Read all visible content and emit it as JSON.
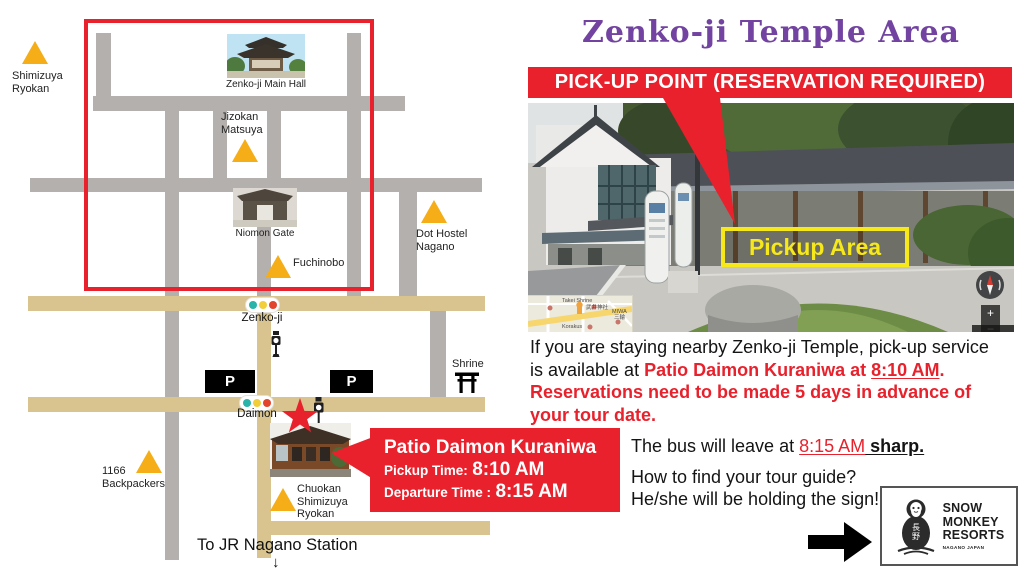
{
  "title": "Zenko-ji Temple Area",
  "banner": "PICK-UP POINT (RESERVATION REQUIRED)",
  "colors": {
    "red": "#e8212c",
    "purple_title": "#7243a0",
    "marker_yellow": "#f5ad18",
    "road_gray": "#b3b0ae",
    "road_tan": "#d9c48f",
    "pickup_yellow": "#f6e819",
    "signal_teal": "#2ab3a9",
    "signal_yellow": "#f2cf3a",
    "signal_red": "#e2452c"
  },
  "map": {
    "poi_shimizuya": "Shimizuya Ryokan",
    "caption_main_hall": "Zenko-ji Main Hall",
    "poi_jizokan": "Jizokan Matsuya",
    "caption_niomon": "Niomon Gate",
    "poi_fuchinobo": "Fuchinobo",
    "poi_dot_hostel": "Dot Hostel Nagano",
    "stop_zenkoji": "Zenko-ji",
    "stop_daimon": "Daimon",
    "shrine": "Shrine",
    "parking": "P",
    "poi_1166": "1166 Backpackers",
    "poi_chuokan": "Chuokan Shimizuya Ryokan",
    "to_station": "To JR Nagano Station",
    "down_arrow": "↓"
  },
  "callout": {
    "title": "Patio Daimon Kuraniwa",
    "pickup_label": "Pickup Time:",
    "pickup_time": "8:10 AM",
    "departure_label": "Departure Time :",
    "departure_time": "8:15 AM"
  },
  "photo": {
    "pickup_area": "Pickup Area",
    "zoom_in": "+",
    "zoom_out": "−",
    "inset": {
      "takei": "Takei Shrine",
      "takei_jp": "武井神社",
      "miwa": "MIWA",
      "miwa_jp": "三輪",
      "korakus": "Korakus"
    }
  },
  "info": {
    "line1": "If you are staying nearby Zenko-ji Temple, pick-up service",
    "line2_black": "is available at ",
    "line2_red": "Patio Daimon Kuraniwa at ",
    "line2_time": "8:10 AM",
    "line2_end": ".",
    "line3": "Reservations need to be made 5 days in advance of",
    "line4": "your tour date.",
    "bus_black": "The bus will leave at ",
    "bus_time": "8:15 AM",
    "bus_sharp": " sharp.",
    "guide_q": "How to find your tour guide?",
    "guide_a": "He/she will be holding the sign!"
  },
  "logo": {
    "jp1": "長",
    "jp2": "野",
    "snow": "SNOW",
    "monkey": "MONKEY",
    "resorts": "RESORTS",
    "sub": "NAGANO JAPAN"
  }
}
